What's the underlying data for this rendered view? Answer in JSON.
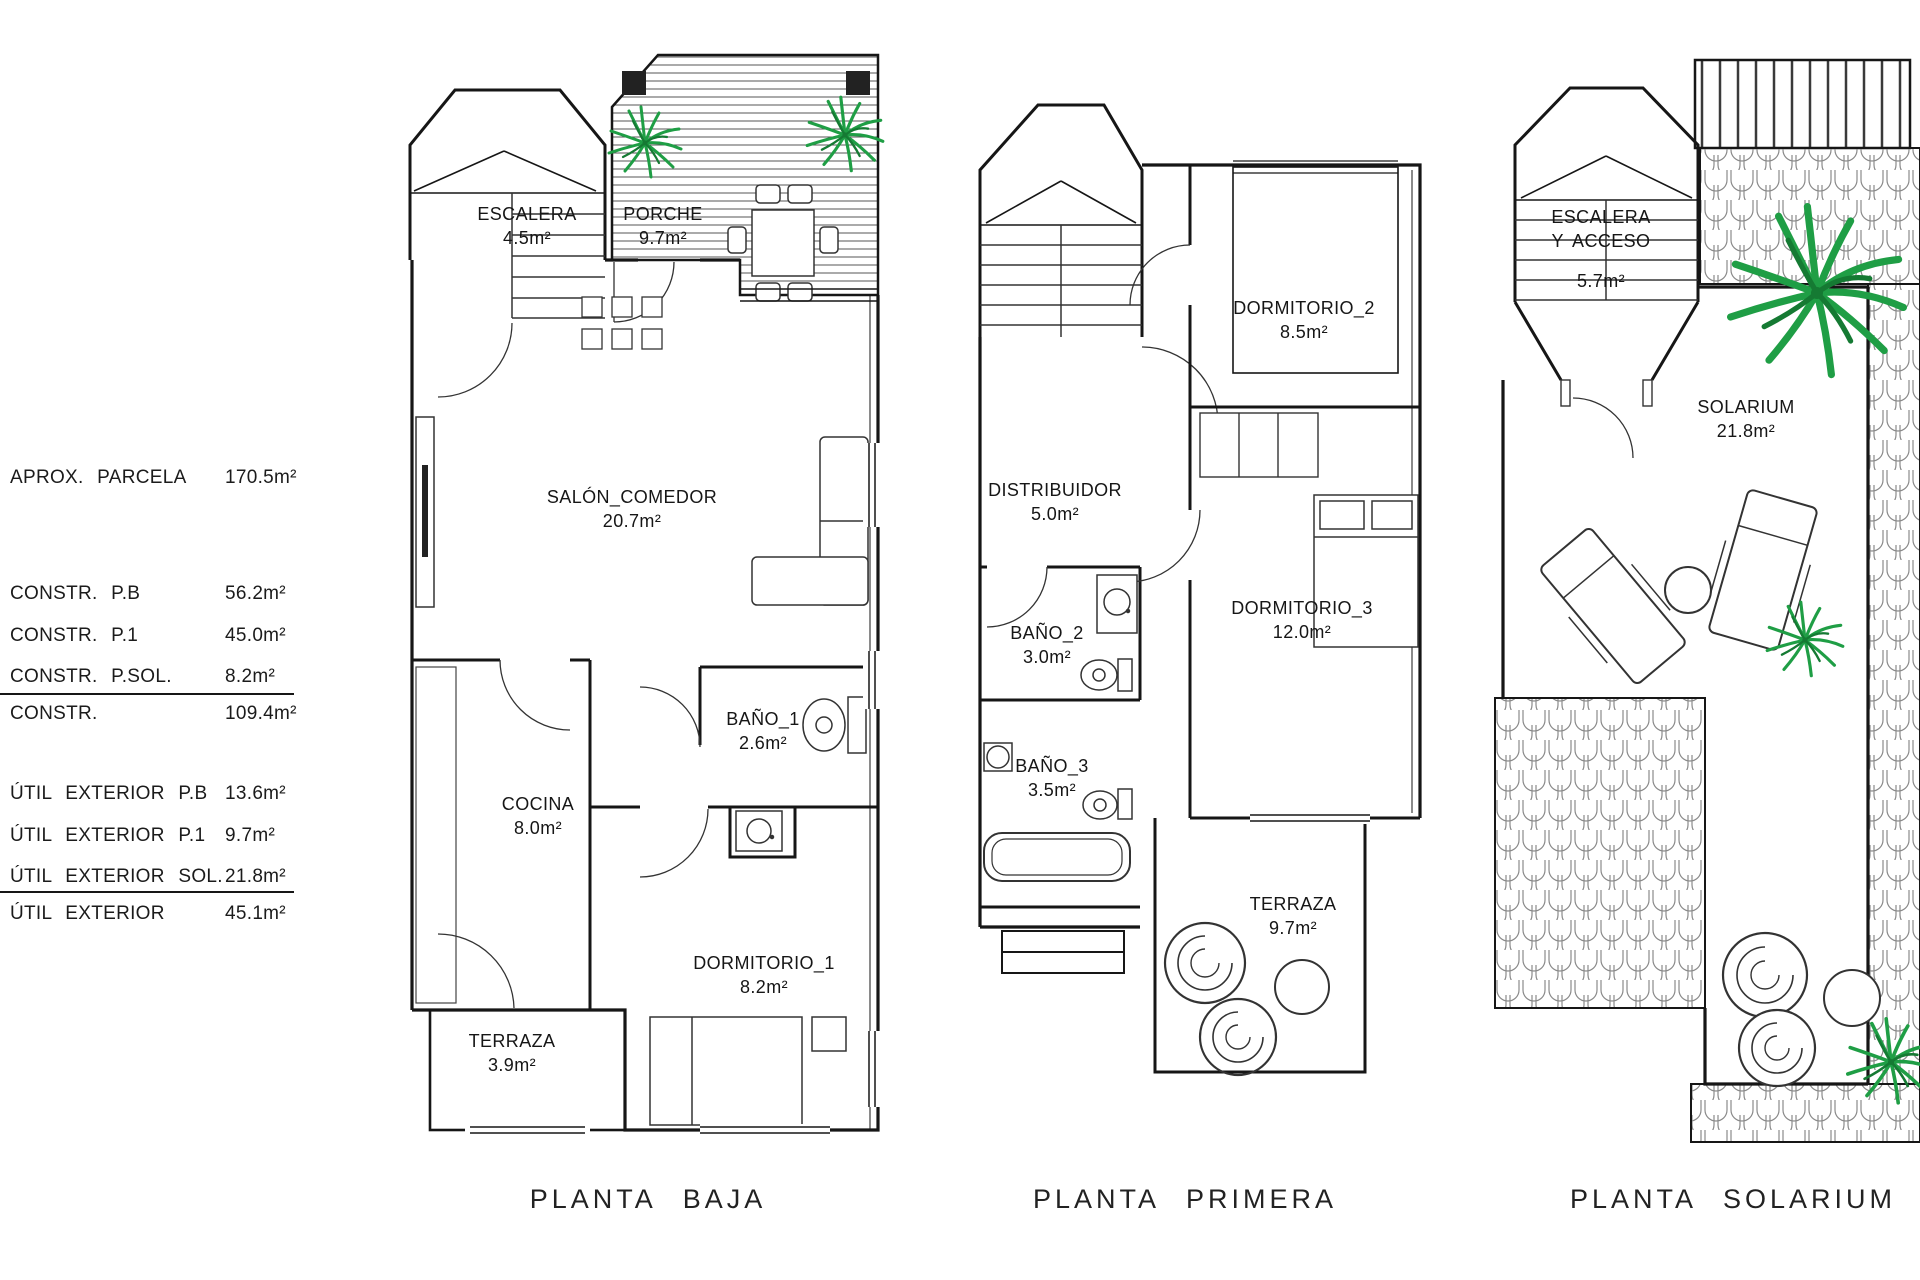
{
  "legend": {
    "rows": [
      {
        "label": "APROX. PARCELA",
        "value": "170.5m²"
      },
      {
        "label": "CONSTR. P.B",
        "value": "56.2m²"
      },
      {
        "label": "CONSTR. P.1",
        "value": "45.0m²"
      },
      {
        "label": "CONSTR. P.SOL.",
        "value": "8.2m²"
      },
      {
        "label": "CONSTR.",
        "value": "109.4m²"
      },
      {
        "label": "ÚTIL EXTERIOR P.B",
        "value": "13.6m²"
      },
      {
        "label": "ÚTIL EXTERIOR P.1",
        "value": "9.7m²"
      },
      {
        "label": "ÚTIL EXTERIOR SOL.",
        "value": "21.8m²"
      },
      {
        "label": "ÚTIL EXTERIOR",
        "value": "45.1m²"
      }
    ]
  },
  "plans": [
    {
      "title": "PLANTA BAJA",
      "rooms": {
        "escalera": {
          "name": "ESCALERA",
          "area": "4.5m²"
        },
        "porche": {
          "name": "PORCHE",
          "area": "9.7m²"
        },
        "salon": {
          "name": "SALÓN_COMEDOR",
          "area": "20.7m²"
        },
        "bano1": {
          "name": "BAÑO_1",
          "area": "2.6m²"
        },
        "cocina": {
          "name": "COCINA",
          "area": "8.0m²"
        },
        "dormitorio1": {
          "name": "DORMITORIO_1",
          "area": "8.2m²"
        },
        "terraza": {
          "name": "TERRAZA",
          "area": "3.9m²"
        }
      }
    },
    {
      "title": "PLANTA PRIMERA",
      "rooms": {
        "dormitorio2": {
          "name": "DORMITORIO_2",
          "area": "8.5m²"
        },
        "distribuidor": {
          "name": "DISTRIBUIDOR",
          "area": "5.0m²"
        },
        "bano2": {
          "name": "BAÑO_2",
          "area": "3.0m²"
        },
        "dormitorio3": {
          "name": "DORMITORIO_3",
          "area": "12.0m²"
        },
        "bano3": {
          "name": "BAÑO_3",
          "area": "3.5m²"
        },
        "terraza": {
          "name": "TERRAZA",
          "area": "9.7m²"
        }
      }
    },
    {
      "title": "PLANTA SOLARIUM",
      "rooms": {
        "escalera": {
          "name": "ESCALERA",
          "name2": "Y ACCESO",
          "area": "5.7m²"
        },
        "solarium": {
          "name": "SOLARIUM",
          "area": "21.8m²"
        }
      }
    }
  ],
  "colors": {
    "ink": "#161616",
    "plant_green": "#1f9e45",
    "paper": "#ffffff"
  }
}
